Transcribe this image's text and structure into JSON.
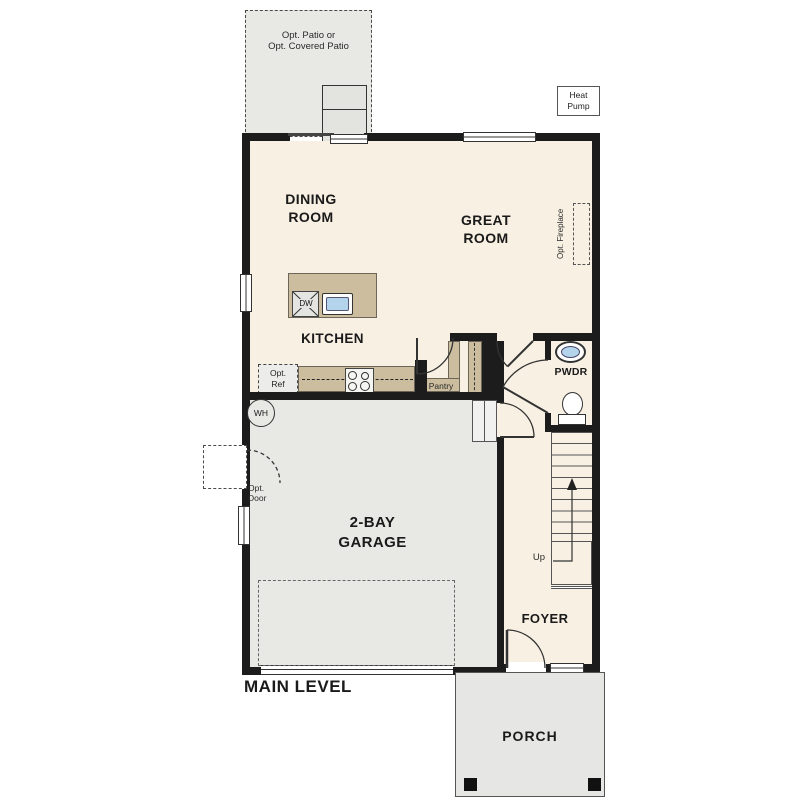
{
  "title": "MAIN LEVEL",
  "colors": {
    "floor_interior": "#f8f0e3",
    "floor_concrete": "#e8e8e5",
    "cabinet_tan": "#cbbd9e",
    "fixture_blue": "#b3d4ea",
    "wall": "#1c1c1c"
  },
  "rooms": {
    "dining": [
      "DINING",
      "ROOM"
    ],
    "great": [
      "GREAT",
      "ROOM"
    ],
    "kitchen": "KITCHEN",
    "garage": [
      "2-BAY",
      "GARAGE"
    ],
    "foyer": "FOYER",
    "porch": "PORCH",
    "pwdr": "PWDR",
    "pantry": "Pantry"
  },
  "annotations": {
    "patio": [
      "Opt. Patio or",
      "Opt. Covered Patio"
    ],
    "heat_pump": [
      "Heat",
      "Pump"
    ],
    "opt_fireplace": "Opt. Fireplace",
    "opt_ref": [
      "Opt.",
      "Ref"
    ],
    "opt_door": [
      "Opt.",
      "Door"
    ],
    "water_heater": "WH",
    "dishwasher": "DW",
    "stairs_up": "Up"
  }
}
